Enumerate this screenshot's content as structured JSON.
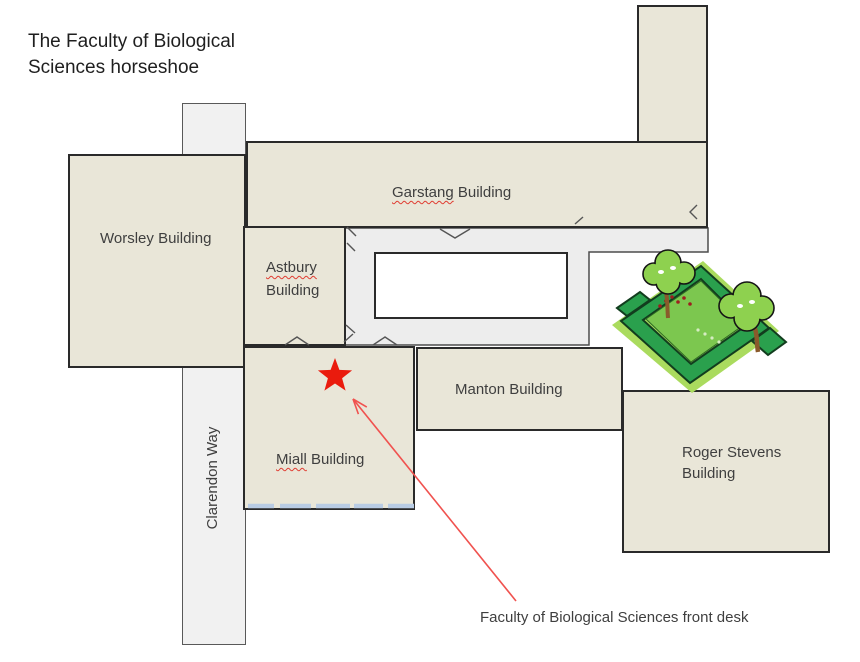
{
  "page": {
    "title_line1": "The Faculty of Biological",
    "title_line2": "Sciences horseshoe"
  },
  "buildings": {
    "worsley": {
      "label": "Worsley Building"
    },
    "garstang": {
      "word": "Garstang",
      "rest": " Building"
    },
    "astbury": {
      "word": "Astbury",
      "rest": " Building"
    },
    "miall": {
      "word": "Miall",
      "rest": " Building"
    },
    "manton": {
      "label": "Manton Building"
    },
    "roger_stevens": {
      "label": "Roger Stevens Building"
    }
  },
  "road": {
    "label": "Clarendon Way"
  },
  "annotation": {
    "front_desk": "Faculty of Biological Sciences front desk"
  },
  "icons": {
    "front_desk_marker": "red-star-icon",
    "pointer_arrow": "red-arrow-icon",
    "garden": "garden-hedges-icon"
  },
  "colors": {
    "building_fill": "#e9e6d8",
    "building_border": "#2a2a2a",
    "path_fill": "#ededed",
    "path_border": "#4d4d4d",
    "road_fill": "#f1f1f1",
    "road_border": "#595959",
    "courtyard_inner_fill": "#ffffff",
    "star_red": "#ea1b0d",
    "arrow_red": "#f0524f",
    "steps_blue": "#b9cce4",
    "label_color": "#3f3f3f",
    "title_color": "#1f1f1f",
    "misspell_underline": "#e03c31"
  }
}
